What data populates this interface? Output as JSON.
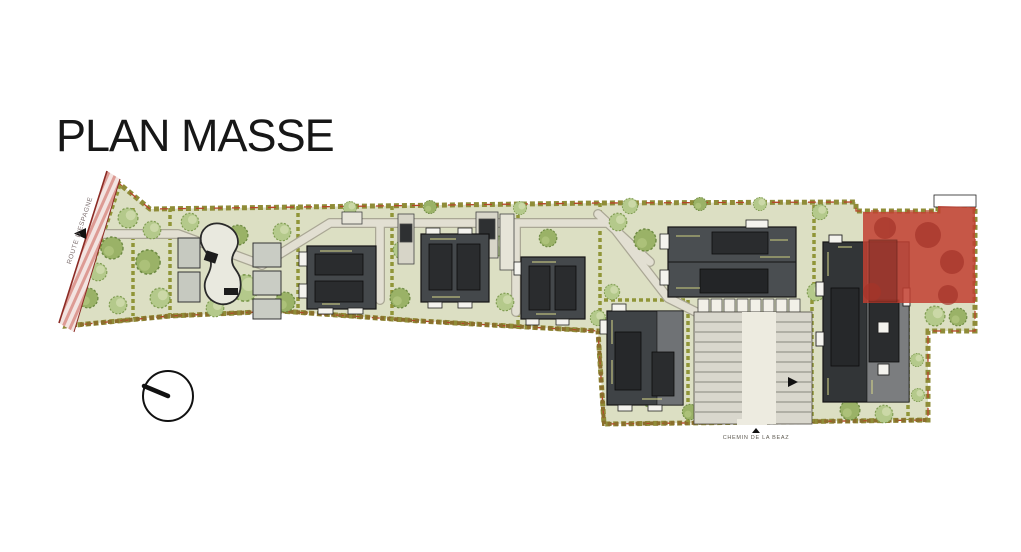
{
  "title": "PLAN MASSE",
  "plan": {
    "road_label": "ROUTE D'ESPAGNE",
    "street_label": "CHEMIN DE LA BEAZ",
    "highlight_color": "#c23f31",
    "ground_color": "#dcdfc3",
    "building_dark": "#3e4245",
    "hedge_color": "#8f8c38"
  },
  "icons": {
    "north_arrow": "north-arrow-icon",
    "entrance_arrow": "entrance-arrow-icon",
    "street_arrow": "street-direction-arrow-icon"
  }
}
